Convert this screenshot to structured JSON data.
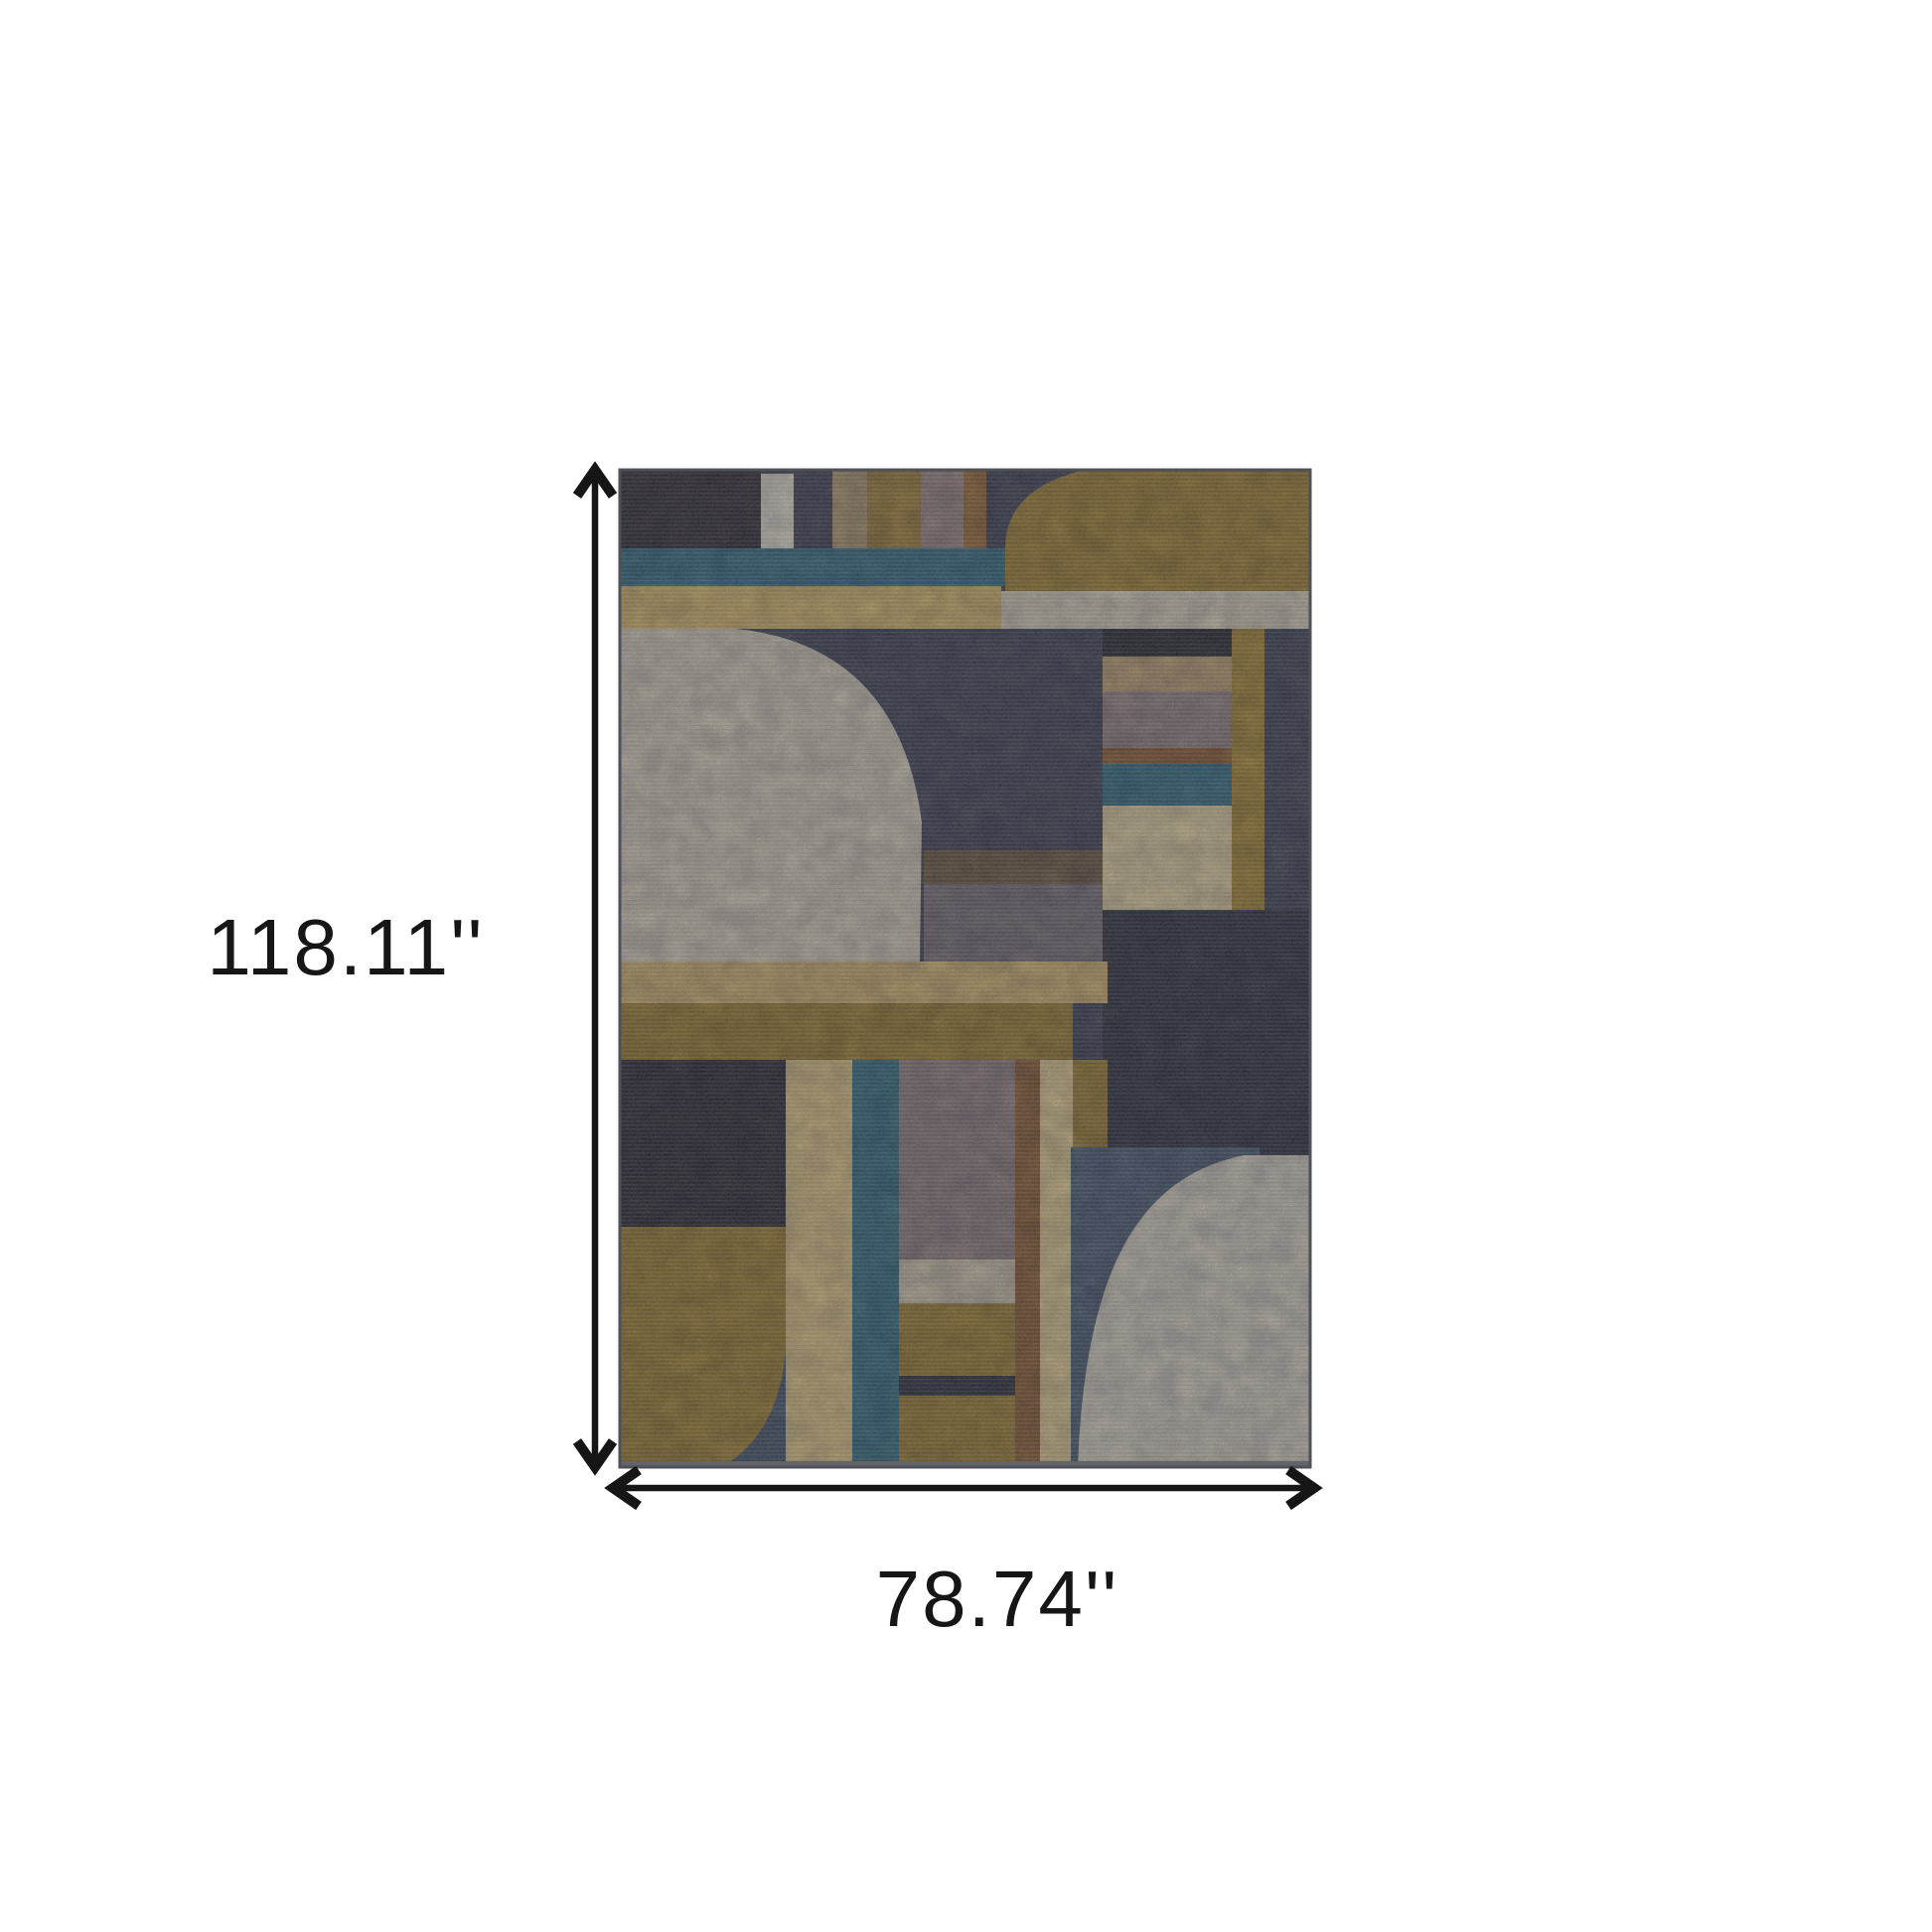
{
  "figure": {
    "subject": "Abstract geometric art-deco area rug product photo with dimension arrows"
  },
  "dimensions": {
    "height_label": "118.11''",
    "width_label": "78.74''"
  },
  "annotation": {
    "arrow_color": "#161616",
    "text_color": "#161616"
  },
  "palette": {
    "navy_base": "#3a4050",
    "charcoal": "#2d2831",
    "cream_bar": "#e7dfc8",
    "tan": "#b0986b",
    "gold": "#9e7c33",
    "mauve": "#9a8680",
    "amber": "#95652f",
    "gold_block": "#9f7d2c",
    "teal": "#2e6b7d",
    "straw": "#d8b766",
    "cream_band": "#d9cfb2",
    "cream_blob": "#d6ccb3",
    "stack_dark": "#23242c",
    "stack_tan": "#bca06c",
    "stack_mauve": "#93817e",
    "stack_orange": "#8e5a2e",
    "stack_teal": "#2f6b7c",
    "stack_pale": "#e2d09a",
    "gold_column": "#a8862f",
    "navy_dark": "#282c39",
    "brown_streak": "#6e5a36",
    "mauve_patch": "#7e7076",
    "straw2": "#d2b26b",
    "mustard_band": "#9a7a2b",
    "black_block": "#26242e",
    "mustard_block": "#9d7d2c",
    "fan_slate": "#3f5064",
    "straw_col": "#dfc57e",
    "teal_col": "#2e6a7b",
    "mauve2": "#8f7d7b",
    "orange_col": "#8b5a2e",
    "pale_col": "#e2cb8a",
    "gold_col2": "#9a7a2e",
    "beige_band": "#cfc4a5",
    "navy_bar": "#272b37",
    "slate": "#46596d",
    "cream_blob2": "#d7cfba",
    "rug_edge": "#4e505a",
    "rug_shadow": "#63636a"
  }
}
